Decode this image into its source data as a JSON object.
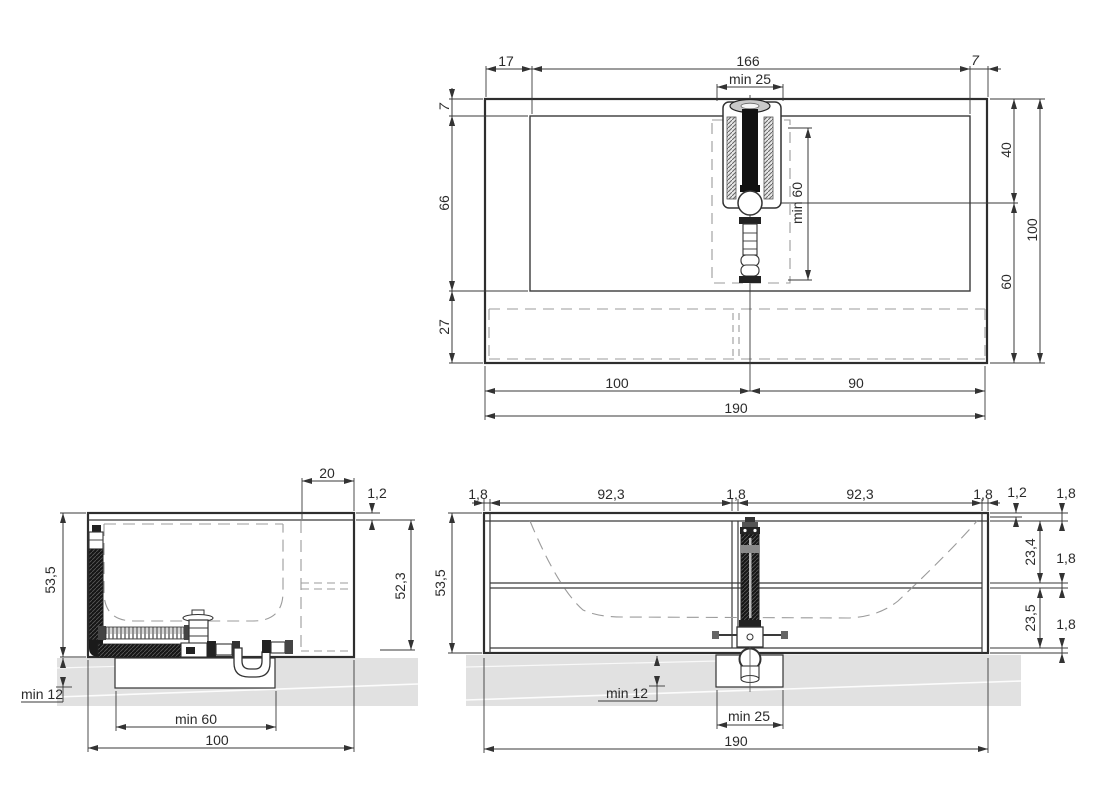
{
  "drawing_type": "bathtub / vanity unit dimensional drawing",
  "colors": {
    "line": "#3a3a3a",
    "dashed": "#9b9b9b",
    "wall_fill": "#e1e1e1"
  },
  "views": {
    "plan": {
      "title": "plan-view",
      "dims": {
        "top_left": "17",
        "basin_width": "166",
        "top_right": "7",
        "tap_clearance_width": "min 25",
        "rim_front": "7",
        "basin_depth": "66",
        "apron": "27",
        "right_upper": "40",
        "right_lower": "60",
        "right_total": "100",
        "tap_clearance_depth": "min 60",
        "bottom_left": "100",
        "bottom_right": "90",
        "total_width": "190"
      }
    },
    "side": {
      "title": "side-section-view",
      "dims": {
        "shelf": "20",
        "top_panel": "1,2",
        "height": "53,5",
        "inner_height": "52,3",
        "recess_depth": "min 12",
        "recess_width": "min 60",
        "total_depth": "100"
      }
    },
    "front": {
      "title": "front-section-view",
      "dims": {
        "end_panel_left": "1,8",
        "bay_left": "92,3",
        "mid_panel": "1,8",
        "bay_right": "92,3",
        "end_panel_right": "1,8",
        "top_panel": "1,2",
        "rail_top": "1,8",
        "upper_shelf": "23,4",
        "rail_mid": "1,8",
        "lower_shelf": "23,5",
        "rail_bottom": "1,8",
        "height": "53,5",
        "recess_depth": "min 12",
        "recess_width": "min 25",
        "total_width": "190"
      }
    }
  }
}
